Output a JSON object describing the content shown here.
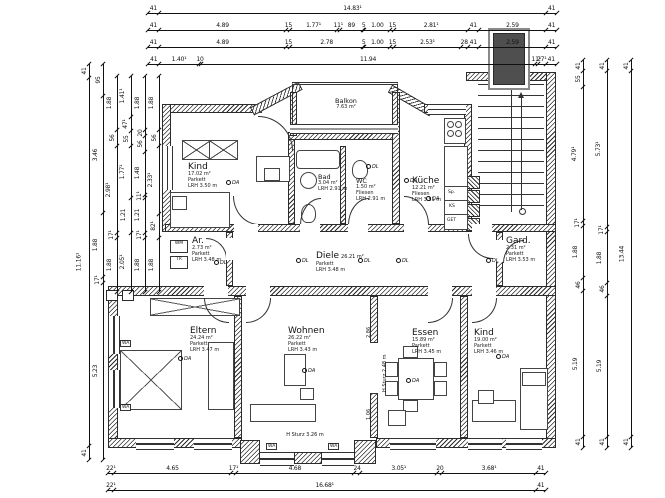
{
  "rooms": [
    {
      "id": "kind-tl",
      "name": "Kind",
      "area": "17.02 m²",
      "floor": "Parkett",
      "lrh": "LRH 3.50 m"
    },
    {
      "id": "bad",
      "name": "Bad",
      "area": "3.04 m²",
      "floor": "Fliesen",
      "lrh": "LRH 2.91 m"
    },
    {
      "id": "wc",
      "name": "WC",
      "area": "1.50 m²",
      "floor": "Fliesen",
      "lrh": "LRH 2.91 m"
    },
    {
      "id": "kueche",
      "name": "Küche",
      "area": "12.21 m²",
      "floor": "Fliesen",
      "lrh": "LRH 3.51 m"
    },
    {
      "id": "balkon",
      "name": "Balkon",
      "area": "7.63 m²",
      "floor": "",
      "lrh": ""
    },
    {
      "id": "diele",
      "name": "Diele",
      "area": "26.21 m²",
      "floor": "Parkett",
      "lrh": "LRH 3.48 m"
    },
    {
      "id": "ar",
      "name": "Ar.",
      "area": "2.73 m²",
      "floor": "Parkett",
      "lrh": "LRH 3.48 m"
    },
    {
      "id": "gard",
      "name": "Gard.",
      "area": "2.31 m²",
      "floor": "Parkett",
      "lrh": "LRH 3.53 m"
    },
    {
      "id": "eltern",
      "name": "Eltern",
      "area": "24.24 m²",
      "floor": "Parkett",
      "lrh": "LRH 3.47 m"
    },
    {
      "id": "wohnen",
      "name": "Wohnen",
      "area": "26.22 m²",
      "floor": "Parkett",
      "lrh": "LRH 3.43 m"
    },
    {
      "id": "essen",
      "name": "Essen",
      "area": "15.89 m²",
      "floor": "Parkett",
      "lrh": "LRH 3.45 m"
    },
    {
      "id": "kind-br",
      "name": "Kind",
      "area": "19.00 m²",
      "floor": "Parkett",
      "lrh": "LRH 3.46 m"
    }
  ],
  "dimensions": {
    "top_rows": [
      [
        "41",
        "14.83¹",
        "41"
      ],
      [
        "41",
        "4.89",
        "15",
        "1.77¹",
        "11¹",
        "89",
        "5",
        "1.00",
        "15",
        "2.81¹",
        "41",
        "2.59",
        "41"
      ],
      [
        "41",
        "4.89",
        "15",
        "2.78",
        "5",
        "1.00",
        "15",
        "2.53¹",
        "28",
        "41",
        "2.59",
        "41"
      ],
      [
        "41",
        "1.40¹",
        "10",
        "11.94",
        "11¹",
        "27¹",
        "41"
      ]
    ],
    "bottom_rows": [
      [
        "22¹",
        "4.65",
        "17¹",
        "4.68",
        "24",
        "3.05¹",
        "20",
        "3.68¹",
        "41"
      ],
      [
        "22¹",
        "16.68¹",
        "41"
      ]
    ],
    "left_cols": [
      [
        "41",
        "11.16¹",
        "41"
      ],
      [
        "95",
        "3.46",
        "1.88",
        "17¹",
        "5.23"
      ],
      [
        "1.88",
        "56",
        "2.98¹",
        "17¹",
        "1.88"
      ],
      [
        "1.41¹",
        "47¹",
        "55",
        "1.77¹",
        "1.21",
        "2.05¹"
      ],
      [
        "1.88",
        "20",
        "56",
        "1.48",
        "11¹",
        "1.21",
        "17¹",
        "1.88"
      ],
      [
        "1.88",
        "56",
        "2.33¹",
        "82¹",
        "1.88"
      ]
    ],
    "right_cols": [
      [
        "41",
        "55",
        "4.79¹",
        "17¹",
        "1.88",
        "46",
        "5.19",
        "41"
      ],
      [
        "41",
        "5.73¹",
        "17¹",
        "1.88",
        "46",
        "5.19",
        "41"
      ],
      [
        "41",
        "13.44",
        "41"
      ]
    ]
  },
  "annotations": {
    "lintel_bay": "H Sturz 3.26 m",
    "lintel_wall": "H Sturz 2.48 m",
    "opening_dims": [
      "2.86",
      "1.06"
    ],
    "appliances": {
      "wm": "WM",
      "tr": "TR",
      "ks": "KS",
      "get": "GET",
      "sp": "Sp.",
      "wa": "WA"
    },
    "symbols": {
      "da": "DA",
      "dl": "DL"
    }
  },
  "colors": {
    "line": "#1a1a1a",
    "wall_hatch": "#2b2b2b",
    "shaft_fill": "#4f4f4f",
    "background": "#ffffff"
  }
}
